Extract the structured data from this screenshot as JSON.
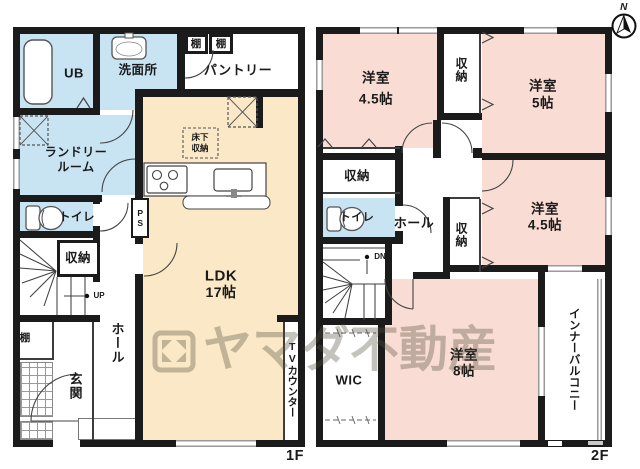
{
  "watermark": {
    "brand": "ヤマダ不動産"
  },
  "compass": {
    "north": "N"
  },
  "floor1": {
    "floor_label": "1F",
    "ub": "UB",
    "washroom": "洗面所",
    "shelf_top_a": "棚",
    "shelf_top_b": "棚",
    "pantry": "パントリー",
    "laundry_1": "ランドリー",
    "laundry_2": "ルーム",
    "toilet": "トイレ",
    "storage": "収納",
    "underfloor_1": "床下",
    "underfloor_2": "収納",
    "ldk_1": "LDK",
    "ldk_2": "17帖",
    "stairs_up": "UP",
    "pipe_space": "PS",
    "shelf_entry": "棚",
    "entrance": "玄関",
    "hall": "ホール",
    "tv_counter": "TVカウンター"
  },
  "floor2": {
    "floor_label": "2F",
    "bedroom_nw_1": "洋室",
    "bedroom_nw_2": "4.5帖",
    "closet_north": "収納",
    "bedroom_ne_1": "洋室",
    "bedroom_ne_2": "5帖",
    "closet_west": "収納",
    "toilet": "トイレ",
    "hall": "ホール",
    "closet_center": "収納",
    "bedroom_e_1": "洋室",
    "bedroom_e_2": "4.5帖",
    "stairs_down": "DN",
    "wic": "WIC",
    "bedroom_s_1": "洋室",
    "bedroom_s_2": "8帖",
    "inner_balcony": "インナーバルコニー"
  }
}
